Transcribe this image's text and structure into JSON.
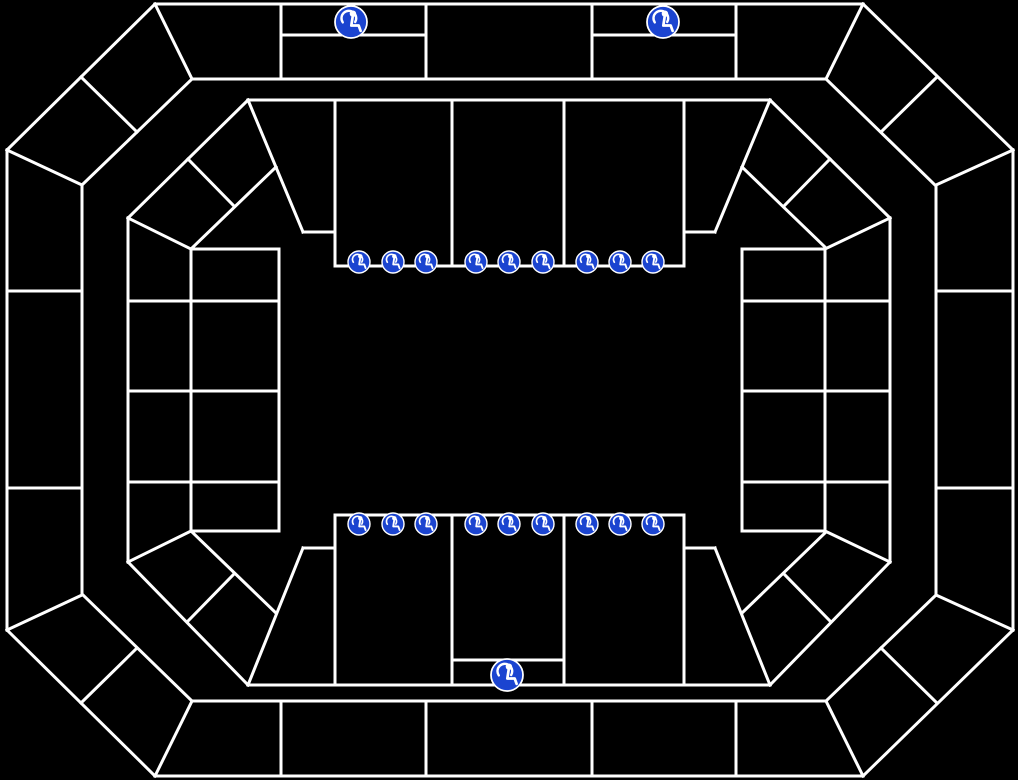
{
  "canvas": {
    "width": 1018,
    "height": 780,
    "background": "#000000"
  },
  "map": {
    "kind": "arena-seating-chart",
    "line_color": "#ffffff",
    "line_width": 3,
    "outer_ring": {
      "segments": [
        [
          155,
          4,
          863,
          4
        ],
        [
          863,
          4,
          1013,
          150
        ],
        [
          1013,
          150,
          1013,
          630
        ],
        [
          1013,
          630,
          863,
          776
        ],
        [
          863,
          776,
          155,
          776
        ],
        [
          155,
          776,
          7,
          630
        ],
        [
          7,
          630,
          7,
          150
        ],
        [
          7,
          150,
          155,
          4
        ],
        [
          192,
          79,
          826,
          79
        ],
        [
          826,
          79,
          935,
          185
        ],
        [
          936,
          185,
          936,
          595
        ],
        [
          936,
          595,
          826,
          701
        ],
        [
          826,
          701,
          192,
          701
        ],
        [
          192,
          701,
          83,
          595
        ],
        [
          82,
          595,
          82,
          185
        ],
        [
          82,
          185,
          192,
          79
        ],
        [
          155,
          4,
          192,
          79
        ],
        [
          863,
          4,
          826,
          79
        ],
        [
          863,
          776,
          826,
          701
        ],
        [
          155,
          776,
          192,
          701
        ],
        [
          7,
          150,
          82,
          185
        ],
        [
          1013,
          150,
          936,
          185
        ],
        [
          7,
          630,
          82,
          595
        ],
        [
          1013,
          630,
          936,
          595
        ],
        [
          81,
          77,
          137,
          132
        ],
        [
          937,
          77,
          881,
          132
        ],
        [
          81,
          703,
          137,
          648
        ],
        [
          937,
          703,
          881,
          648
        ],
        [
          281,
          4,
          281,
          79
        ],
        [
          426,
          4,
          426,
          79
        ],
        [
          592,
          4,
          592,
          79
        ],
        [
          736,
          4,
          736,
          79
        ],
        [
          281,
          701,
          281,
          776
        ],
        [
          426,
          701,
          426,
          776
        ],
        [
          592,
          701,
          592,
          776
        ],
        [
          736,
          701,
          736,
          776
        ],
        [
          281,
          35,
          426,
          35
        ],
        [
          592,
          35,
          736,
          35
        ],
        [
          7,
          291,
          82,
          291
        ],
        [
          7,
          488,
          82,
          488
        ],
        [
          936,
          291,
          1013,
          291
        ],
        [
          936,
          488,
          1013,
          488
        ]
      ]
    },
    "inner_bowl": {
      "segments": [
        [
          248,
          100,
          770,
          100
        ],
        [
          248,
          685,
          770,
          685
        ],
        [
          335,
          266,
          684,
          266
        ],
        [
          335,
          515,
          684,
          515
        ],
        [
          335,
          100,
          335,
          266
        ],
        [
          452,
          100,
          452,
          266
        ],
        [
          564,
          100,
          564,
          266
        ],
        [
          684,
          100,
          684,
          266
        ],
        [
          335,
          515,
          335,
          685
        ],
        [
          452,
          515,
          452,
          685
        ],
        [
          564,
          515,
          564,
          685
        ],
        [
          684,
          515,
          684,
          685
        ],
        [
          452,
          660,
          564,
          660
        ],
        [
          248,
          100,
          303,
          232
        ],
        [
          303,
          232,
          335,
          232
        ],
        [
          770,
          100,
          715,
          232
        ],
        [
          684,
          232,
          715,
          232
        ],
        [
          248,
          685,
          303,
          548
        ],
        [
          303,
          548,
          335,
          548
        ],
        [
          770,
          685,
          715,
          548
        ],
        [
          684,
          548,
          715,
          548
        ],
        [
          248,
          100,
          128,
          218
        ],
        [
          276,
          167,
          192,
          248
        ],
        [
          188,
          159,
          233,
          205
        ],
        [
          770,
          100,
          890,
          218
        ],
        [
          742,
          167,
          826,
          248
        ],
        [
          830,
          159,
          785,
          205
        ],
        [
          248,
          685,
          128,
          562
        ],
        [
          276,
          613,
          192,
          532
        ],
        [
          188,
          621,
          233,
          575
        ],
        [
          770,
          685,
          890,
          562
        ],
        [
          742,
          613,
          826,
          532
        ],
        [
          830,
          621,
          785,
          575
        ],
        [
          128,
          218,
          128,
          562
        ],
        [
          890,
          218,
          890,
          562
        ],
        [
          191,
          249,
          191,
          531
        ],
        [
          279,
          249,
          279,
          531
        ],
        [
          825,
          249,
          825,
          531
        ],
        [
          742,
          249,
          742,
          531
        ],
        [
          191,
          249,
          279,
          249
        ],
        [
          191,
          531,
          279,
          531
        ],
        [
          742,
          249,
          825,
          249
        ],
        [
          742,
          531,
          825,
          531
        ],
        [
          191,
          249,
          128,
          218
        ],
        [
          191,
          531,
          128,
          562
        ],
        [
          825,
          249,
          890,
          218
        ],
        [
          825,
          531,
          890,
          562
        ],
        [
          128,
          301,
          279,
          301
        ],
        [
          128,
          391,
          279,
          391
        ],
        [
          128,
          482,
          279,
          482
        ],
        [
          742,
          301,
          890,
          301
        ],
        [
          742,
          391,
          890,
          391
        ],
        [
          742,
          482,
          890,
          482
        ]
      ]
    },
    "accessible_seating": {
      "icon_semantic": "wheelchair-accessible-icon",
      "icon_fill": "#1b44d0",
      "icon_glyph_color": "#ffffff",
      "large_icons": [
        {
          "x": 351,
          "y": 22,
          "r": 16
        },
        {
          "x": 663,
          "y": 22,
          "r": 16
        },
        {
          "x": 507,
          "y": 675,
          "r": 16
        }
      ],
      "small_icon_rows": [
        {
          "y": 262,
          "r": 11,
          "x": [
            359,
            393,
            426,
            476,
            509,
            543,
            587,
            620,
            653
          ]
        },
        {
          "y": 524,
          "r": 11,
          "x": [
            359,
            393,
            426,
            476,
            509,
            543,
            587,
            620,
            653
          ]
        }
      ]
    }
  }
}
